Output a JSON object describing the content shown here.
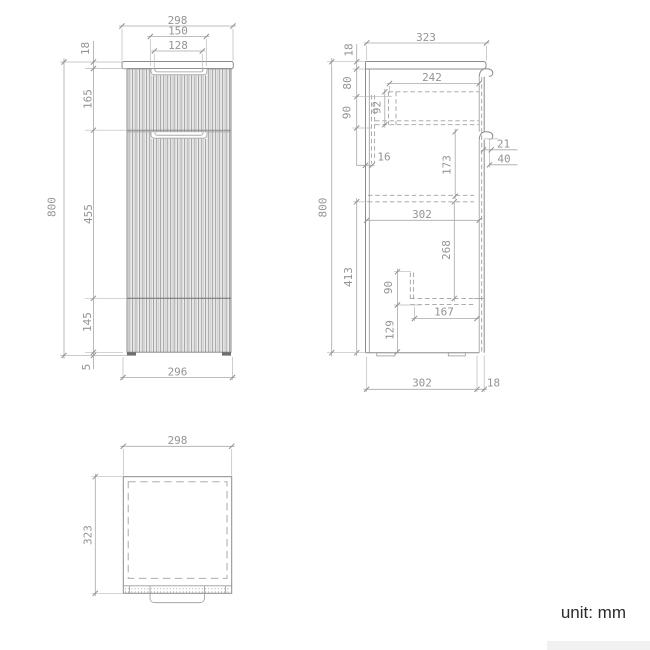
{
  "unit_label": "unit: mm",
  "colors": {
    "background": "#ffffff",
    "outline_gray": "#8c8c8c",
    "dimension_line_gray": "#a8a8a8",
    "dimension_text_gray": "#949494",
    "unit_text": "#2b2b2b",
    "foot_fill": "#6f6f6f",
    "watermark_gray": "#f1f1f1"
  },
  "front_view": {
    "width_top": "298",
    "handle_width": "150",
    "handle_inner_width": "128",
    "countertop_thickness": "18",
    "top_drawer_height": "165",
    "door_height": "455",
    "bottom_drawer_height": "145",
    "foot_height": "5",
    "total_height": "800",
    "width_bottom": "296"
  },
  "side_view": {
    "depth_top": "323",
    "countertop_thickness": "18",
    "top_gap": "80",
    "drawer_side_height": "90",
    "drawer_depth": "242",
    "drawer_box_height": "92",
    "back_gap": "16",
    "door_top_drop": "173",
    "pull_lip": "21",
    "pull_height": "40",
    "inner_depth": "302",
    "shelf_drop": "268",
    "lower_height": "413",
    "shelf_clearance": "90",
    "shelf_depth": "167",
    "plinth_height": "129",
    "total_height": "800",
    "depth_bottom": "302",
    "front_thickness": "18"
  },
  "top_view": {
    "width": "298",
    "depth": "323"
  }
}
